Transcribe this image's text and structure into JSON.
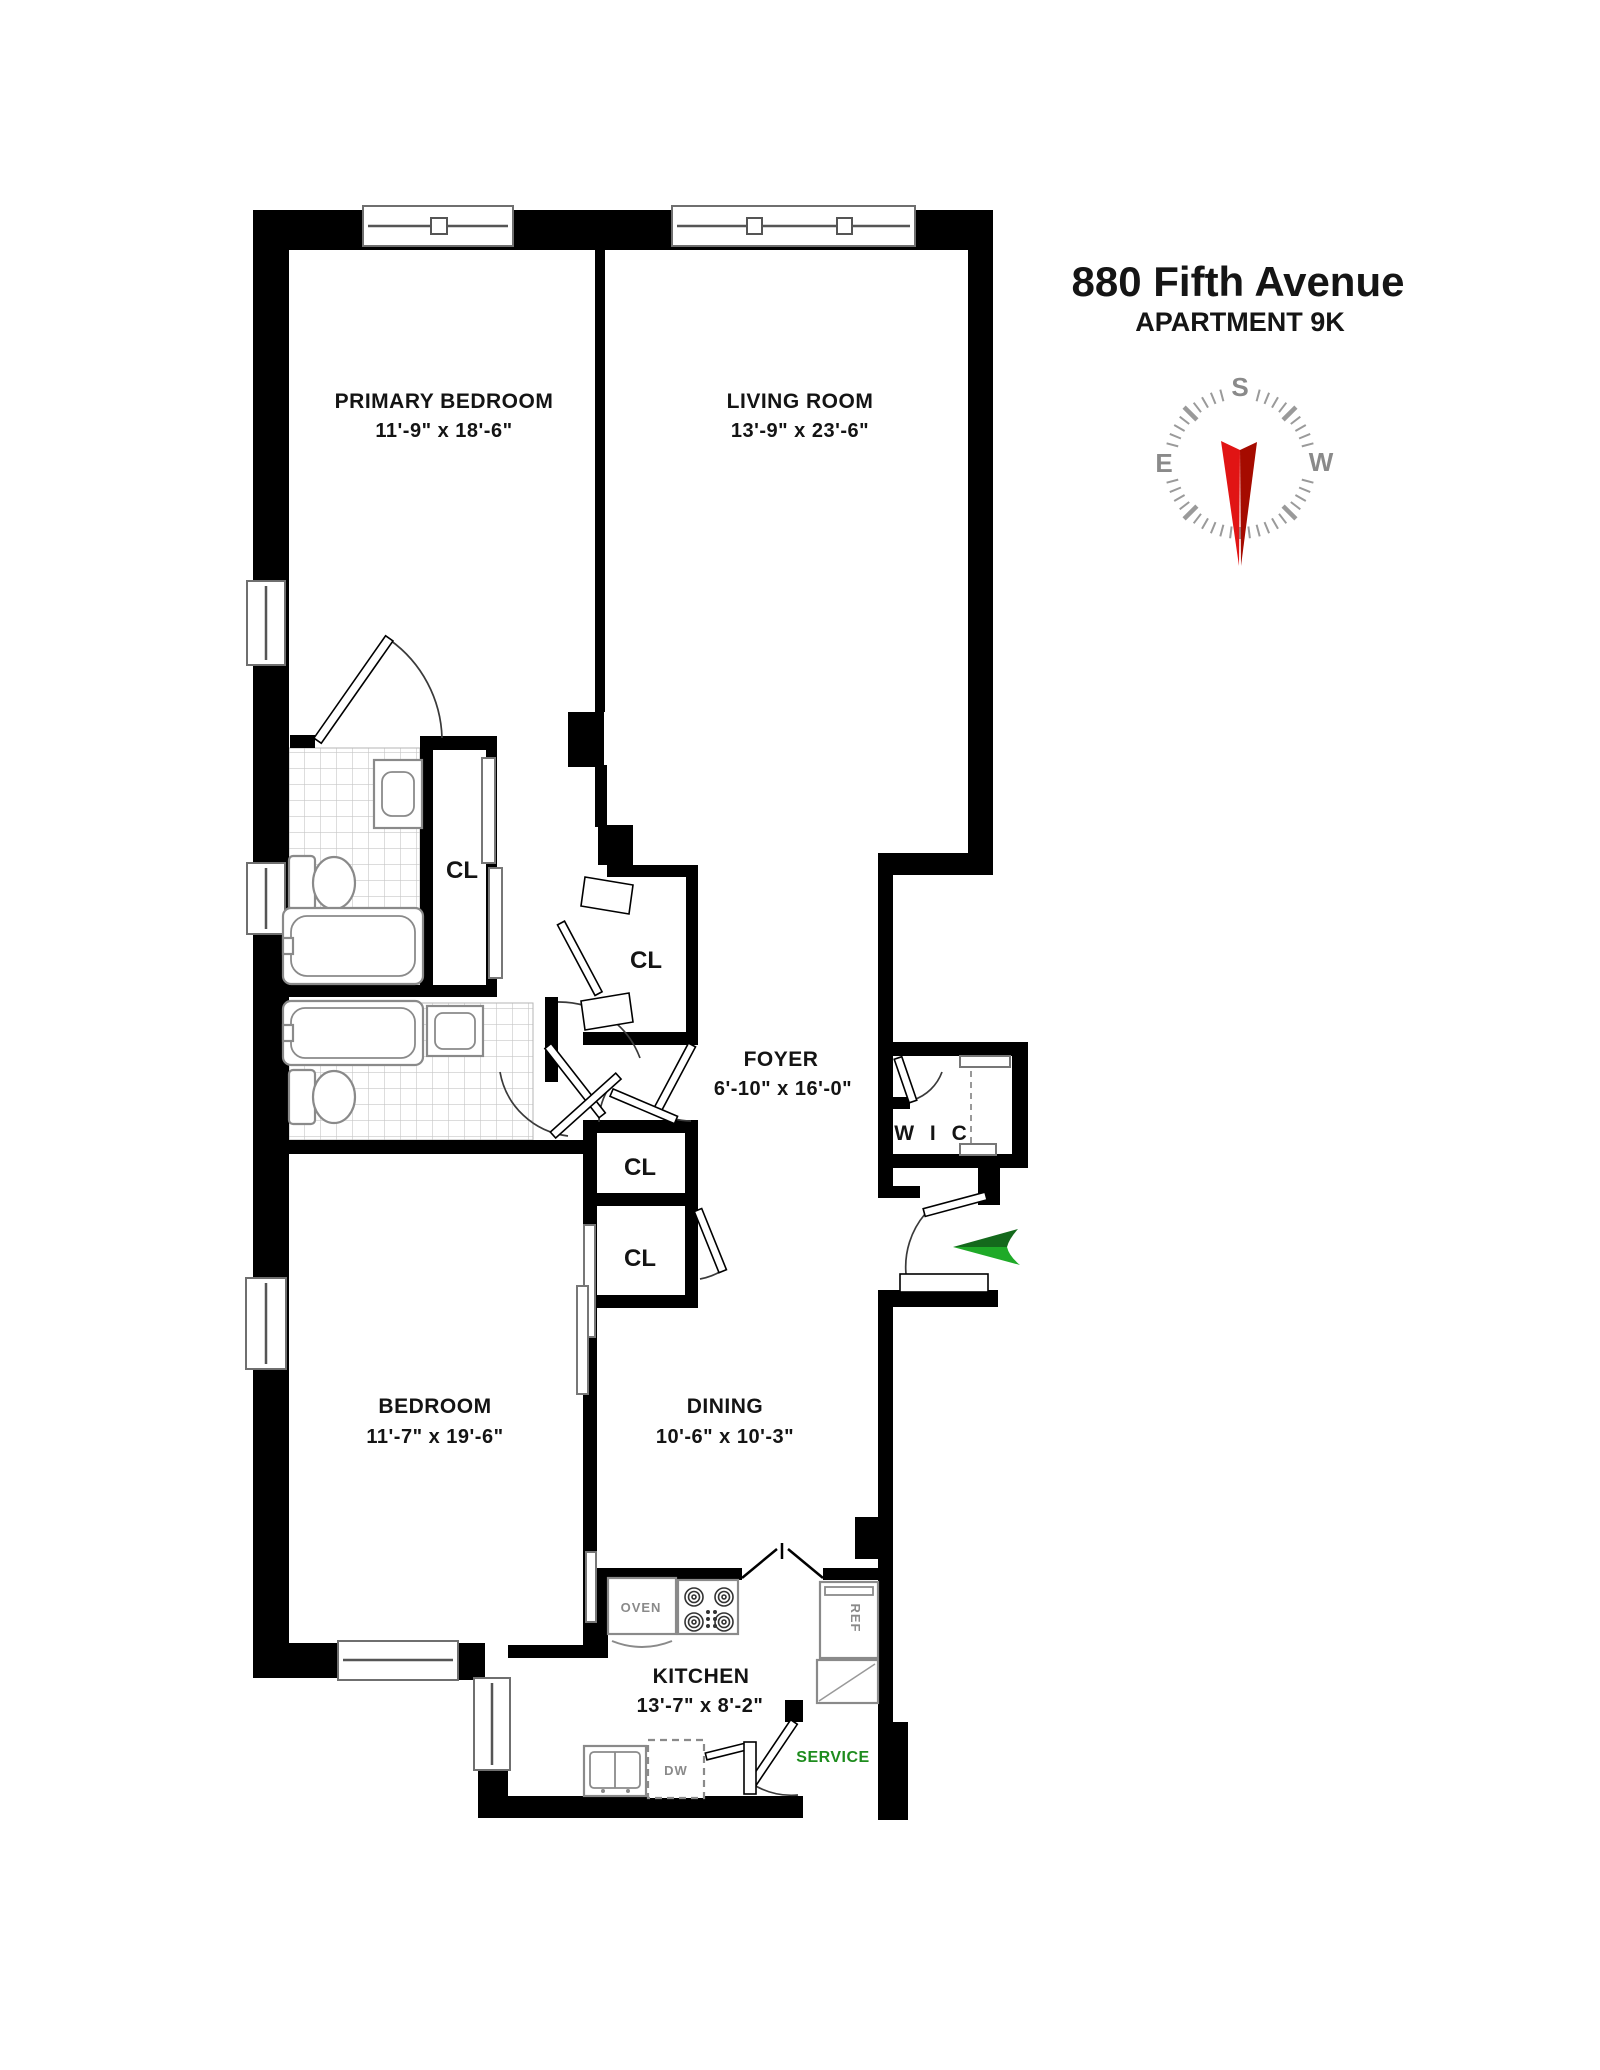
{
  "title": {
    "line1": "880 Fifth Avenue",
    "line2": "APARTMENT 9K"
  },
  "compass": {
    "south": "S",
    "east": "E",
    "west": "W"
  },
  "rooms": {
    "primary_bedroom": {
      "name": "PRIMARY BEDROOM",
      "dims": "11'-9\" x 18'-6\""
    },
    "living_room": {
      "name": "LIVING ROOM",
      "dims": "13'-9\" x 23'-6\""
    },
    "foyer": {
      "name": "FOYER",
      "dims": "6'-10\" x 16'-0\""
    },
    "bedroom": {
      "name": "BEDROOM",
      "dims": "11'-7\" x 19'-6\""
    },
    "dining": {
      "name": "DINING",
      "dims": "10'-6\" x 10'-3\""
    },
    "kitchen": {
      "name": "KITCHEN",
      "dims": "13'-7\" x 8'-2\""
    }
  },
  "closets": {
    "cl_hall": "CL",
    "cl_bifold": "CL",
    "cl_upper": "CL",
    "cl_lower": "CL",
    "wic": "W I C"
  },
  "appliances": {
    "oven": "OVEN",
    "ref": "REF",
    "dw": "DW"
  },
  "annotations": {
    "service": "SERVICE"
  },
  "colors": {
    "wall": "#000000",
    "needle_red_light": "#e11414",
    "needle_red_dark": "#a50b00",
    "arrow_green_dark": "#14691c",
    "arrow_green_light": "#1faa28",
    "service_green": "#1e8c1e",
    "fixture_gray": "#8a8a8a",
    "compass_gray": "#9a9a9a",
    "tile_gray": "#c6c6c6"
  }
}
